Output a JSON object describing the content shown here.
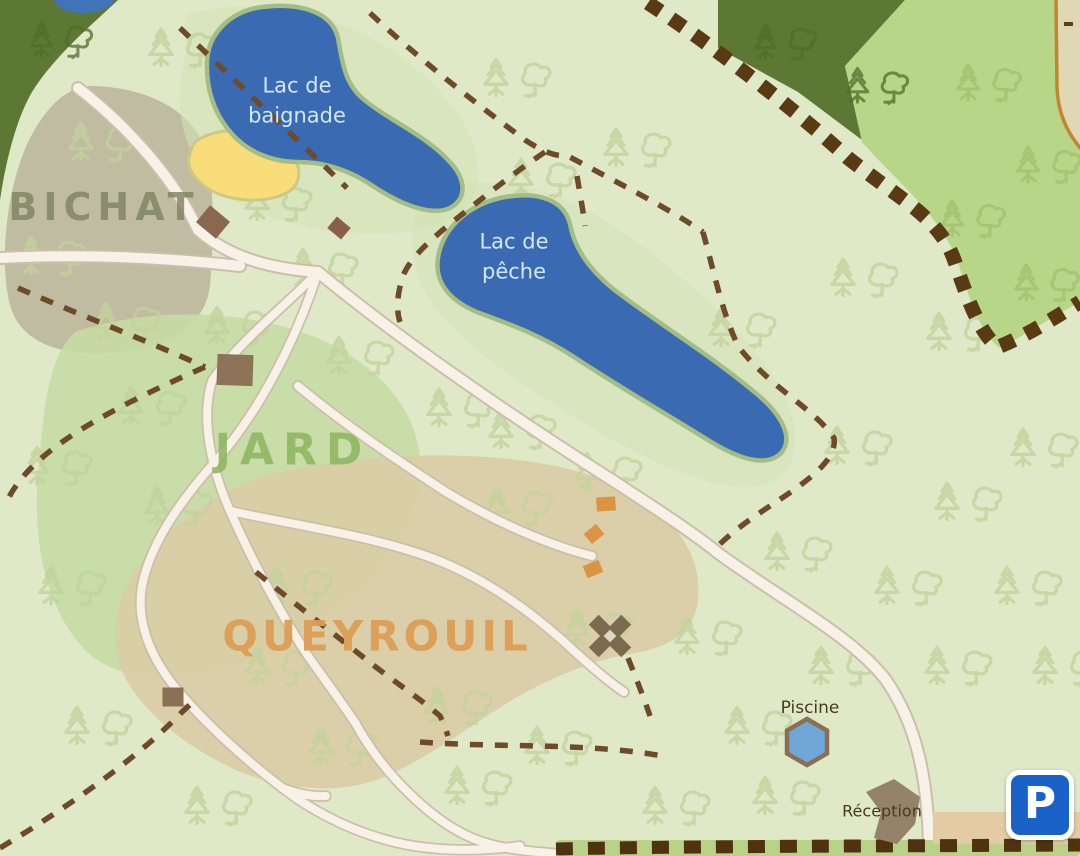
{
  "map": {
    "areas": [
      {
        "id": "bichat",
        "label": "BICHAT"
      },
      {
        "id": "jard",
        "label": "JARD"
      },
      {
        "id": "queyrouil",
        "label": "QUEYROUIL"
      }
    ],
    "lakes": [
      {
        "id": "lac-de-baignade",
        "label": "Lac de baignade"
      },
      {
        "id": "lac-de-peche",
        "label": "Lac de pêche"
      }
    ],
    "facilities": {
      "piscine": {
        "label": "Piscine"
      },
      "reception": {
        "label": "Réception"
      },
      "parking": {
        "label": "P"
      }
    },
    "colors": {
      "background": "#dfe9c8",
      "water": "#3a6ab2",
      "beach": "#f8dd7a",
      "forest_dark": "#5d7834",
      "meadow": "#b7d687",
      "area_bichat": "#bcb79e",
      "area_jard": "#c6dba4",
      "area_queyrouil": "#d9cda6",
      "path": "#f7f1e7",
      "trail_dash": "#6f4a28",
      "boundary_dash": "#5a3a12",
      "bottom_strip": "#b9d288",
      "parking_area": "#e5cba3",
      "parking_sign": "#1b62c8",
      "pool": "#6fa8d8",
      "building_brown": "#8a7054",
      "cabin_orange": "#dc9342"
    }
  }
}
